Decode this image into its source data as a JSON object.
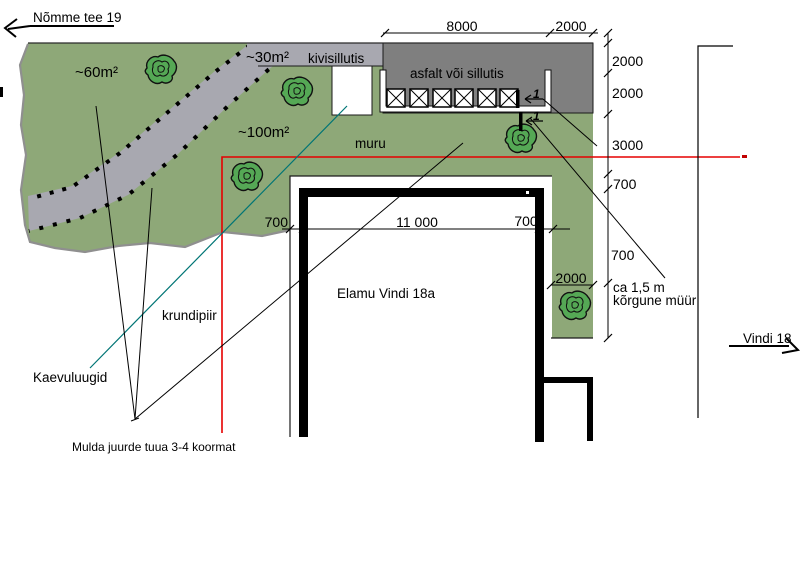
{
  "roads": {
    "top_left": "Nõmme tee 19",
    "right": "Vindi 18"
  },
  "areas": {
    "lawn_60": "~60m²",
    "path_30": "~30m²",
    "lawn_100": "~100m²",
    "stone_paving": "kivisillutis",
    "asphalt": "asfalt või sillutis",
    "lawn_label": "muru"
  },
  "building": {
    "name": "Elamu Vindi 18a"
  },
  "notes": {
    "boundary": "krundipiir",
    "manholes": "Kaevuluugid",
    "soil": "Mulda juurde tuua 3-4 koormat",
    "wall_line1": "ca 1,5 m",
    "wall_line2": "kõrgune müür"
  },
  "dimensions": {
    "top_width": "8000",
    "top_side": "2000",
    "right_1": "2000",
    "right_2": "2000",
    "right_3": "3000",
    "right_4": "700",
    "right_5": "700",
    "strip_width": "2000",
    "house_left": "700",
    "house_width": "11 000",
    "house_right": "700"
  },
  "section_marker": "1",
  "colors": {
    "lawn": "#8ea878",
    "tree": "#55a855",
    "paving": "#a8a8b0",
    "asphalt": "#7f7f7f",
    "boundary_red": "#e60000",
    "manhole_teal": "#007575"
  }
}
